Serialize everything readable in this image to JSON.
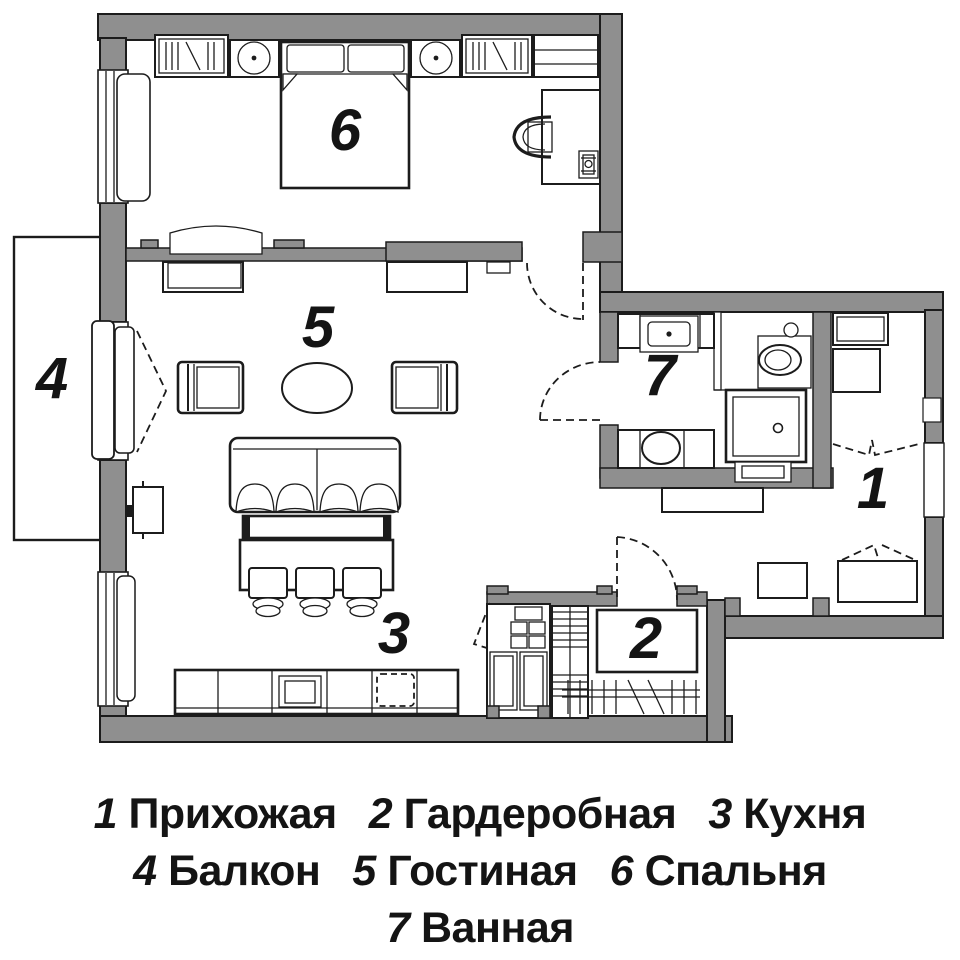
{
  "colors": {
    "wall_fill": "#8f8f8f",
    "line": "#1c1c1c",
    "background": "#ffffff"
  },
  "rooms": [
    {
      "num": "1",
      "name": "Прихожая"
    },
    {
      "num": "2",
      "name": "Гардеробная"
    },
    {
      "num": "3",
      "name": "Кухня"
    },
    {
      "num": "4",
      "name": "Балкон"
    },
    {
      "num": "5",
      "name": "Гостиная"
    },
    {
      "num": "6",
      "name": "Спальня"
    },
    {
      "num": "7",
      "name": "Ванная"
    }
  ],
  "legend_rows": [
    [
      "1 Прихожая",
      "2 Гардеробная",
      "3 Кухня"
    ],
    [
      "4 Балкон",
      "5 Гостиная",
      "6 Спальня"
    ],
    [
      "7 Ванная"
    ]
  ]
}
